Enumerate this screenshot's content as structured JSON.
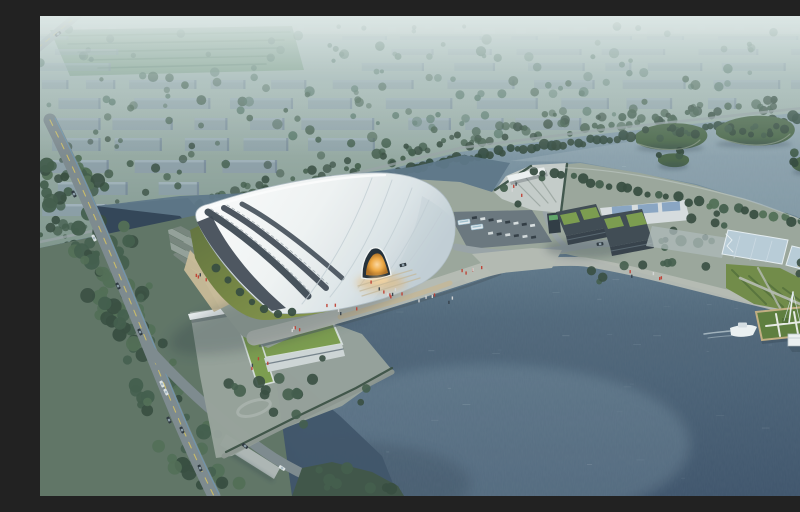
{
  "meta": {
    "title": "Aerial dusk rendering of a lakefront stadium complex",
    "description": "Bird's-eye architectural rendering: a large white shell-roofed stadium with an amber-lit arched entrance sits on a lakefront parcel; a hazy low-rise city with dense trees fills the background; a tree-lined road runs along the left; a peninsula with dark green-roofed buildings, pale blue pools and lawns extends right; wooded islands, a floating green pier with a small pavilion and a moored white boat dot the lake."
  },
  "scene": {
    "background": "hazy low-rise city blocks with dense trees and an open green field",
    "boulevard": "tree-lined boulevard separating city from waterfront",
    "stadium": "white layered-shell stadium, dark glazed base bands, amber glowing arched entrance",
    "waterfront": "curved promenade with tan steps and pedestrian figures",
    "embankment": "terraced bank with sand wedge west of stadium",
    "parking": "car rows and two buses north-east of stadium",
    "gateway": "V-shaped entry plaza with white canopy crossing the channel",
    "peninsula": "two dark mid-rise buildings with green roofs, solar-roof annex, pale blue pools, lawns",
    "pier": "floating green pier with white path pattern, mast, white pavilion, moored boat",
    "islands": "wooded archipelago and small islands in the upper lake",
    "roads": "left road with yellow centerline and blue lane, bottom bridge road over canal",
    "u_building": "low white U-shaped building with green roof and entry canopy on south-west parcel",
    "water": "large lake lower right, dark pond and canal lower left, light channel behind stadium"
  },
  "colors": {
    "haze_top": "#e2ebe9",
    "haze_mid": "#c2d3d2",
    "city_base_top": "#b7c7c4",
    "city_base_bottom": "#7d948a",
    "field": "#7fa089",
    "field_hedge": "#5d8069",
    "block_face": "#8b9dab",
    "block_top": "#a8b8c1",
    "block_side": "#6f8292",
    "horizon_block": "#cdd8d8",
    "tree_hazy": "#557567",
    "tree_mid": "#3f5a48",
    "tree_dark": "#33493c",
    "tree_light": "#4e6b52",
    "boulevard_tree": "#2e463a",
    "water_top": "#9aaeb6",
    "water_mid": "#5f7a8e",
    "water_deep": "#3c5166",
    "water_dark": "#2c3e50",
    "water_light": "#8fa9b8",
    "pond": "#2e4154",
    "channel": "#5b7486",
    "land_base": "#9aa69a",
    "corridor_green": "#5d7263",
    "lawn_bright": "#8fa050",
    "lawn_mid": "#73843f",
    "lawn_dark": "#57683a",
    "shell_white": "#ffffff",
    "shell_light": "#f2f5f5",
    "shell_mid": "#dde5e8",
    "shell_shade": "#c2cfd6",
    "shell_edge": "#aebbc3",
    "seam": "#c3ced4",
    "wall_dark": "#39434e",
    "wall_streak": "#5e6d77",
    "glow_core": "#ffd9a0",
    "glow": "#f2a93f",
    "road": "#7c888d",
    "road_light": "#98a3a6",
    "lane_yellow": "#d9c45d",
    "lane_blue": "#5f9fc8",
    "bridge": "#b6bebc",
    "promenade": "#b7bcb4",
    "steps_tan": "#c6b795",
    "sand": "#cdbd97",
    "terrace_a": "#93a098",
    "terrace_b": "#75837b",
    "seawall": "#8b958e",
    "plaza": "#97a29a",
    "gateway": "#c6cdca",
    "canopy": "#eff3f3",
    "ramp_line": "#96a19b",
    "bldg_dark": "#3b4750",
    "bldg_face": "#323d46",
    "bldg_window": "#5d6c75",
    "roof_green": "#7a9b4a",
    "parapet": "#dfe7e7",
    "annex_white": "#d8dee0",
    "solar_blue": "#7f9fc0",
    "pool_blue": "#b9cdd9",
    "pool_frame": "#e8f0f4",
    "pool_line": "#cfdde6",
    "island_green": "#4a6648",
    "island_edge": "#a4ae9e",
    "pier_green": "#5b7c39",
    "pier_path": "#e9ece6",
    "pier_edge": "#c3ae80",
    "pier_hedge": "#4a6a30",
    "hut_white": "#eef2f3",
    "boat_white": "#eef3f4",
    "boat_cabin": "#d7e0e4",
    "wake": "#d9e5ea",
    "person_red": "#c0392b",
    "person_dark": "#2f3b44",
    "person_light": "#d8d8d8",
    "car_dark": "#2a343c",
    "car_white": "#dfe5e6",
    "bus_white": "#e6edf0",
    "bus_stripe": "#8fb4c6",
    "gate_slab": "#2c3740",
    "gate_screen": "#63b06a",
    "parking": "#68747c",
    "shadow": "#1f2c38",
    "tint": "#a8cdc6"
  }
}
